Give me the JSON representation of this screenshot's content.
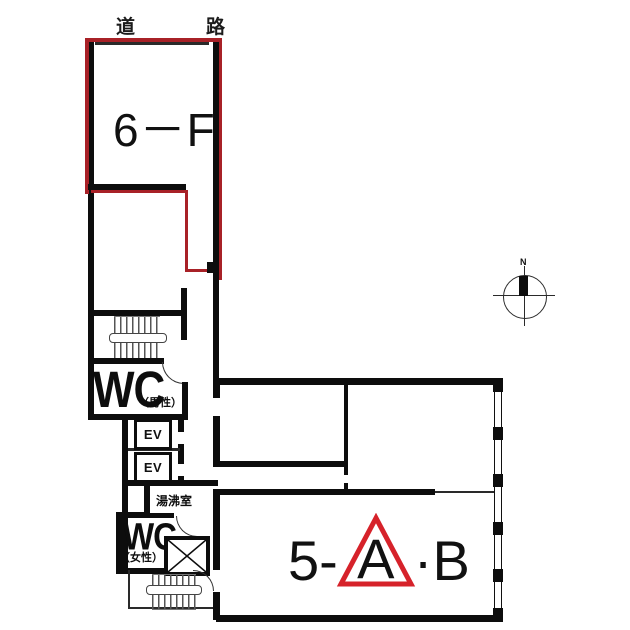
{
  "colors": {
    "wall": "#0d0d0d",
    "unit_outline_red": "#a82127",
    "triangle_red": "#d6222a",
    "background": "#ffffff"
  },
  "labels": {
    "road": "道　路",
    "compass_north": "N"
  },
  "rooms": {
    "unit_6f": {
      "label": "6－F"
    },
    "wc_men": {
      "label": "WC",
      "sublabel": "（男性）"
    },
    "elevators": [
      {
        "label": "EV"
      },
      {
        "label": "EV"
      }
    ],
    "kitchenette": {
      "label": "湯沸室"
    },
    "wc_women": {
      "label": "WC",
      "sublabel": "（女性）"
    },
    "unit_5ab": {
      "prefix": "5-",
      "highlighted": "A",
      "separator": "·",
      "suffix": "B"
    }
  }
}
